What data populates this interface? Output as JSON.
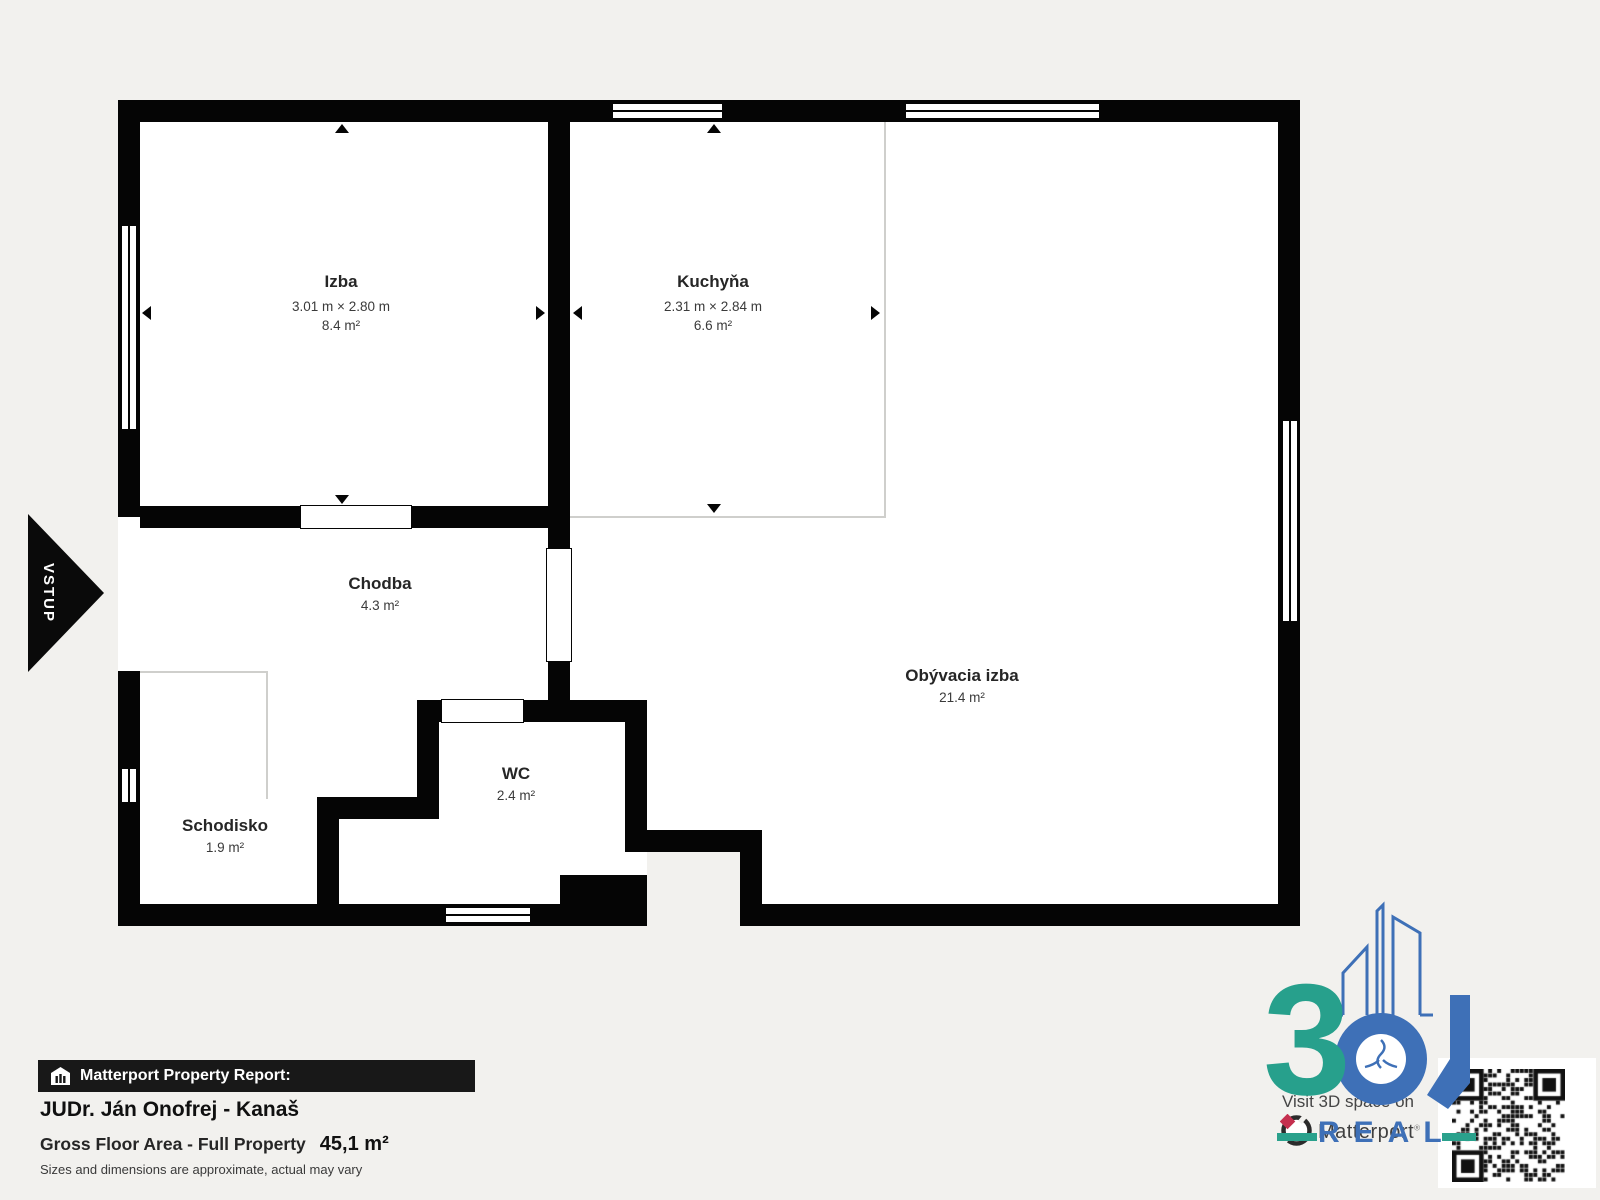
{
  "background_color": "#f2f1ee",
  "entrance": {
    "label": "VSTUP"
  },
  "rooms": [
    {
      "id": "izba",
      "name": "Izba",
      "dimensions": "3.01 m × 2.80 m",
      "area": "8.4 m²"
    },
    {
      "id": "kuchyna",
      "name": "Kuchyňa",
      "dimensions": "2.31 m × 2.84 m",
      "area": "6.6 m²"
    },
    {
      "id": "chodba",
      "name": "Chodba",
      "area": "4.3 m²"
    },
    {
      "id": "obyvacia",
      "name": "Obývacia izba",
      "area": "21.4 m²"
    },
    {
      "id": "wc",
      "name": "WC",
      "area": "2.4 m²"
    },
    {
      "id": "schodisko",
      "name": "Schodisko",
      "area": "1.9 m²"
    }
  ],
  "report": {
    "bar_label": "Matterport Property Report:",
    "property_name": "JUDr. Ján Onofrej - Kanaš",
    "area_label": "Gross Floor Area - Full Property",
    "area_value": "45,1 m²",
    "disclaimer": "Sizes and dimensions are approximate, actual may vary"
  },
  "branding": {
    "visit_text": "Visit 3D space on",
    "matterport_label": "Matterport",
    "logo_text_3": "3",
    "logo_real": "REAL",
    "colors": {
      "teal": "#27a08c",
      "blue": "#3e70b7",
      "crimson": "#c52f4e",
      "wall": "#050505"
    }
  }
}
